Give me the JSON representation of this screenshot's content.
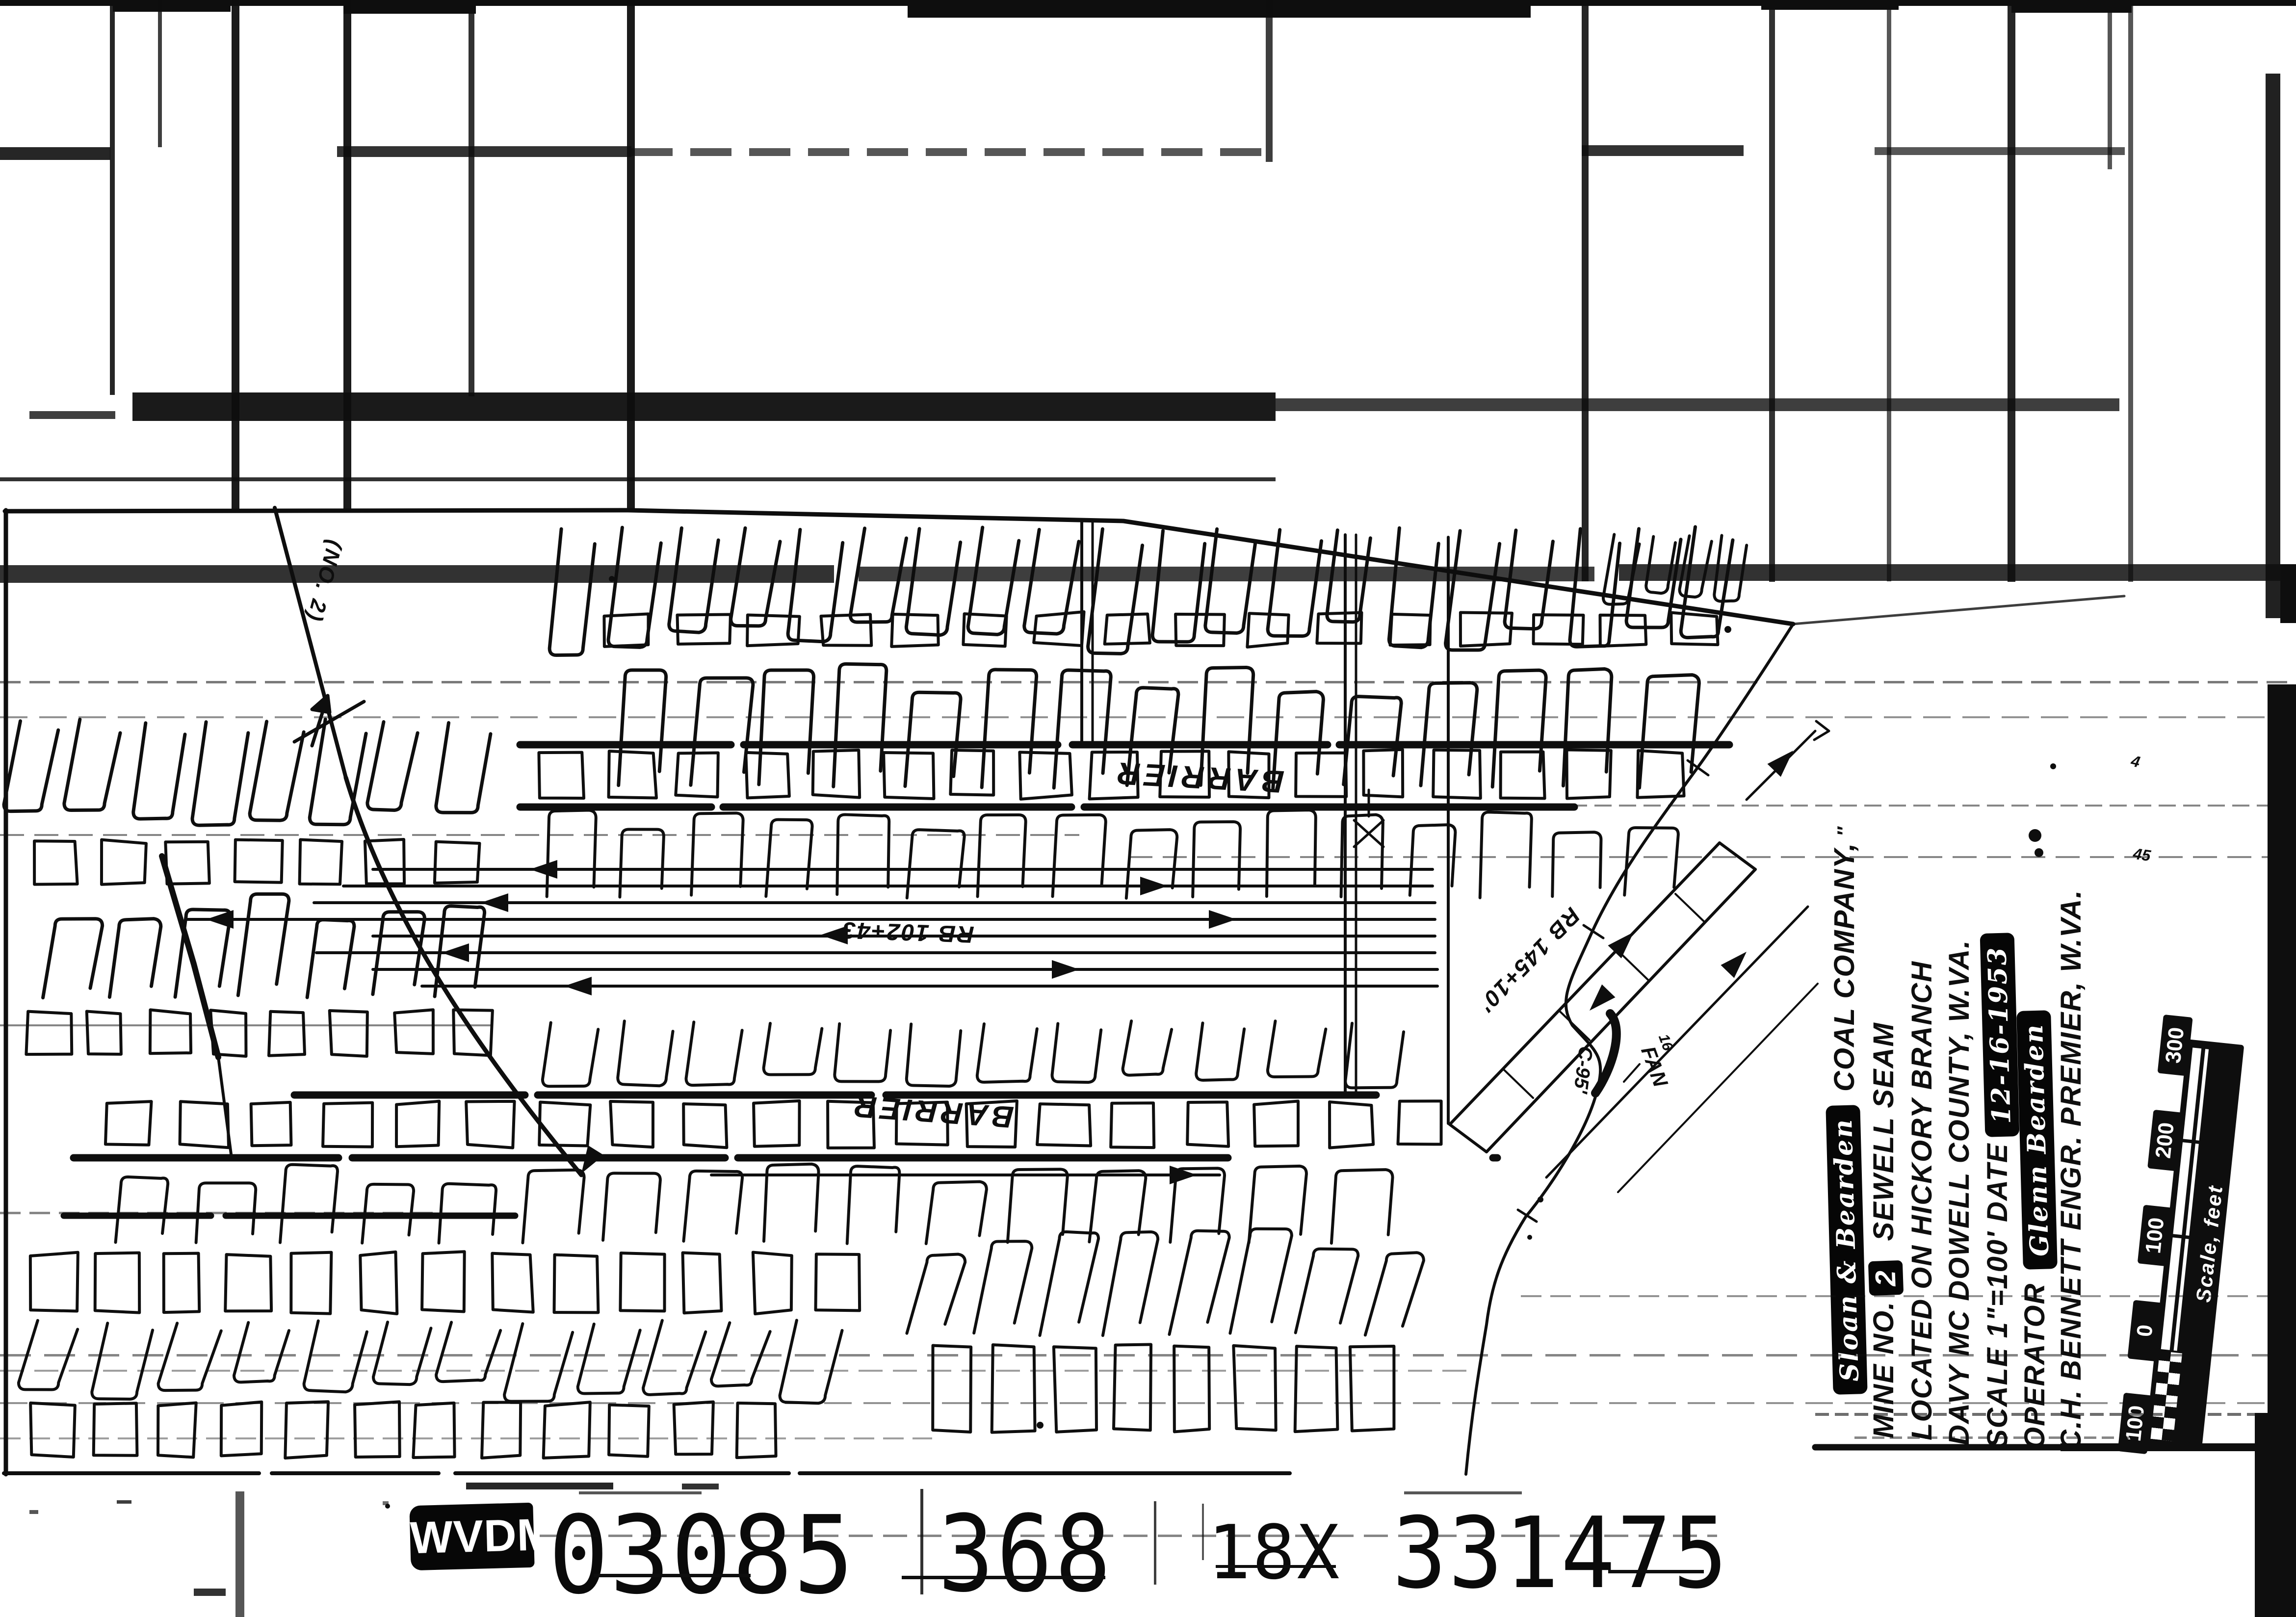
{
  "film_strip": {
    "badge": "WVDM",
    "groups": [
      "03085",
      "368",
      "18X",
      "331475"
    ]
  },
  "map": {
    "labels": {
      "barrier_top": "BARRIER",
      "barrier_bottom": "BARRIER",
      "survey_rb102": "RB 102+43'",
      "survey_rb145": "RB 145+10'",
      "seam_line": "(NO. 2)",
      "c95": "C-95'",
      "fan": "FAN",
      "fan_no": "16",
      "elev_4": "4",
      "elev_45": "45"
    }
  },
  "title_block": {
    "company_script": "Sloan & Bearden",
    "company": "COAL COMPANY,",
    "company_mark": "″",
    "mine_prefix": "MINE  NO.",
    "mine_no": "2",
    "seam": "SEWELL SEAM",
    "located": "LOCATED ON    HICKORY BRANCH",
    "county": "DAVY MC DOWELL COUNTY, W.VA.",
    "scale_date": "SCALE 1\"=100'    DATE",
    "date_script": "12-16-1953",
    "operator_label": "OPERATOR",
    "operator_script": "Glenn Bearden",
    "engineer": "C.H. BENNETT ENGR. PREMIER, W.VA."
  },
  "scale_bar": {
    "ticks": [
      "100",
      "0",
      "100",
      "200",
      "300"
    ],
    "caption": "Scale, feet"
  },
  "colors": {
    "ink": "#0e0e0e",
    "paper": "#ffffff"
  }
}
